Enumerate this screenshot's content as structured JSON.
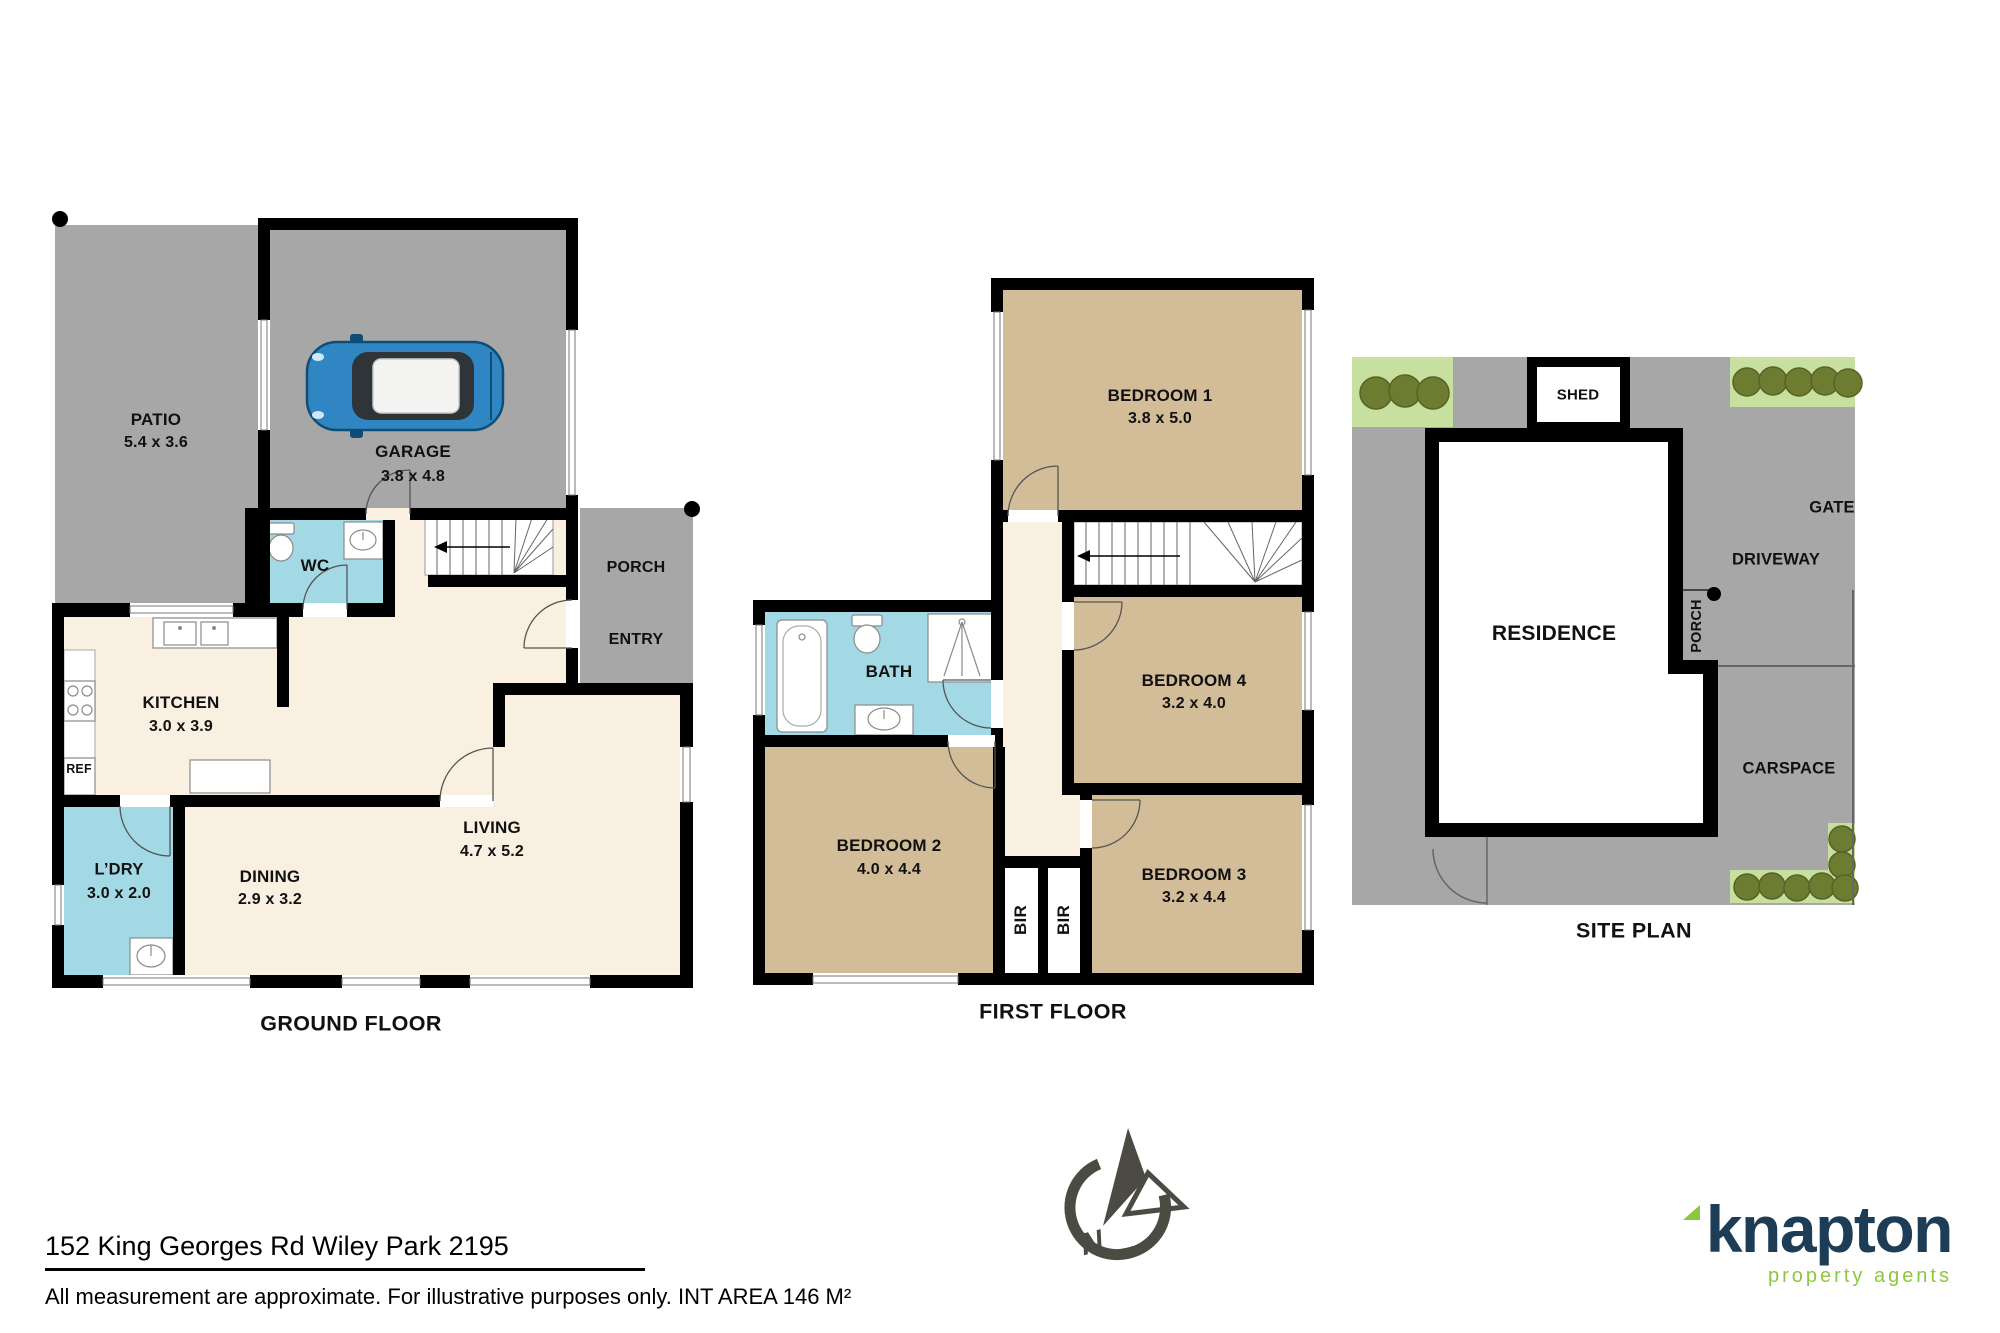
{
  "ground_floor": {
    "title": "GROUND FLOOR",
    "rooms": {
      "patio": {
        "name": "PATIO",
        "dims": "5.4 x 3.6"
      },
      "garage": {
        "name": "GARAGE",
        "dims": "3.8 x 4.8"
      },
      "wc": {
        "name": "WC"
      },
      "porch": {
        "name": "PORCH"
      },
      "entry": {
        "name": "ENTRY"
      },
      "kitchen": {
        "name": "KITCHEN",
        "dims": "3.0 x 3.9"
      },
      "ref": {
        "name": "REF"
      },
      "laundry": {
        "name": "L’DRY",
        "dims": "3.0 x 2.0"
      },
      "dining": {
        "name": "DINING",
        "dims": "2.9 x 3.2"
      },
      "living": {
        "name": "LIVING",
        "dims": "4.7 x 5.2"
      }
    }
  },
  "first_floor": {
    "title": "FIRST FLOOR",
    "rooms": {
      "bedroom1": {
        "name": "BEDROOM 1",
        "dims": "3.8 x 5.0"
      },
      "bath": {
        "name": "BATH"
      },
      "bedroom4": {
        "name": "BEDROOM 4",
        "dims": "3.2 x 4.0"
      },
      "bedroom2": {
        "name": "BEDROOM 2",
        "dims": "4.0 x 4.4"
      },
      "bedroom3": {
        "name": "BEDROOM 3",
        "dims": "3.2 x 4.4"
      },
      "bir1": {
        "name": "BIR"
      },
      "bir2": {
        "name": "BIR"
      }
    }
  },
  "site_plan": {
    "title": "SITE PLAN",
    "labels": {
      "shed": "SHED",
      "residence": "RESIDENCE",
      "gate": "GATE",
      "driveway": "DRIVEWAY",
      "porch": "PORCH",
      "carspace": "CARSPACE"
    }
  },
  "compass": {
    "north_label": "N"
  },
  "footer": {
    "address": "152 King Georges Rd Wiley Park 2195",
    "disclaimer": "All measurement are approximate. For illustrative purposes only. INT AREA 146 M²"
  },
  "branding": {
    "logo_text": "knapton",
    "logo_tagline": "property agents"
  },
  "colors": {
    "wall": "#000000",
    "floor_cream": "#FAF0E1",
    "bedroom_tan": "#D3BD98",
    "wet_area_blue": "#A2D9E5",
    "outdoor_gray": "#A7A7A7",
    "garden_green": "#C7E0A0",
    "bush_olive": "#6D7C31",
    "logo_navy": "#1D3C55",
    "logo_green": "#8DC63F",
    "compass_gray": "#4B4B44"
  }
}
